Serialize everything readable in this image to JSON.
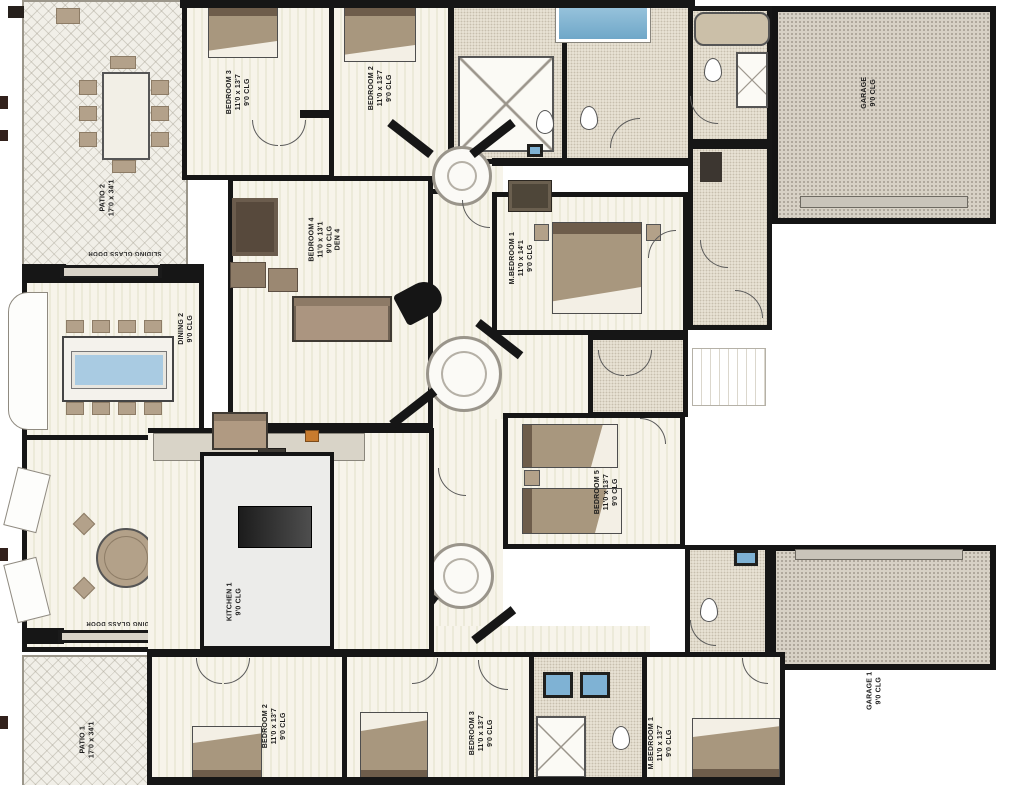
{
  "plan_title": "Residential duplex floor plan (rotated 180°)",
  "labels": {
    "patio2": {
      "name": "PATIO 2",
      "dims": "17'0 x 34'1"
    },
    "bedroom3_top": {
      "name": "BEDROOM 3",
      "dims": "11'0 x 13'7",
      "clg": "9'0 CLG"
    },
    "bedroom2_top": {
      "name": "BEDROOM 2",
      "dims": "11'0 x 13'7",
      "clg": "9'0 CLG"
    },
    "garage_top": {
      "name": "GARAGE",
      "clg": "9'0 CLG"
    },
    "mbedroom_top": {
      "name": "M.BEDROOM 1",
      "dims": "11'0 x 14'1",
      "clg": "9'0 CLG"
    },
    "bedroom4": {
      "name": "BEDROOM 4",
      "dims": "11'0 x 13'1",
      "clg": "9'0 CLG",
      "extra": "DEN 4"
    },
    "dining2": {
      "name": "DINING 2",
      "clg": "9'0 CLG"
    },
    "bedroom5": {
      "name": "BEDROOM 5",
      "dims": "11'0 x 13'7",
      "clg": "9'0 CLG"
    },
    "breakfast1": {
      "name": "BREAKFAST 1",
      "clg": "9'0 CLG"
    },
    "kitchen1": {
      "name": "KITCHEN 1",
      "clg": "9'0 CLG"
    },
    "slider_top": "SLIDING GLASS DOOR",
    "slider_bottom": "SLIDING GLASS DOOR",
    "patio1": {
      "name": "PATIO 1",
      "dims": "17'0 x 34'1"
    },
    "bedroom2_bot": {
      "name": "BEDROOM 2",
      "dims": "11'0 x 13'7",
      "clg": "9'0 CLG"
    },
    "bedroom3_bot": {
      "name": "BEDROOM 3",
      "dims": "11'0 x 13'7",
      "clg": "9'0 CLG"
    },
    "mbedroom_bot": {
      "name": "M.BEDROOM 1",
      "dims": "11'0 x 13'7",
      "clg": "9'0 CLG"
    },
    "garage_bot": {
      "name": "GARAGE 1",
      "clg": "9'0 CLG"
    }
  },
  "colors": {
    "wall": "#161616",
    "wood_floor": "#f6f3e9",
    "patio_floor": "#f1efe8",
    "garage_floor": "#d7d1c5",
    "tile_floor": "#e7e1d3",
    "furniture_tan": "#b09a82",
    "glass_blue": "#a9cbe2",
    "pool_blue": "#8fc0dc"
  }
}
